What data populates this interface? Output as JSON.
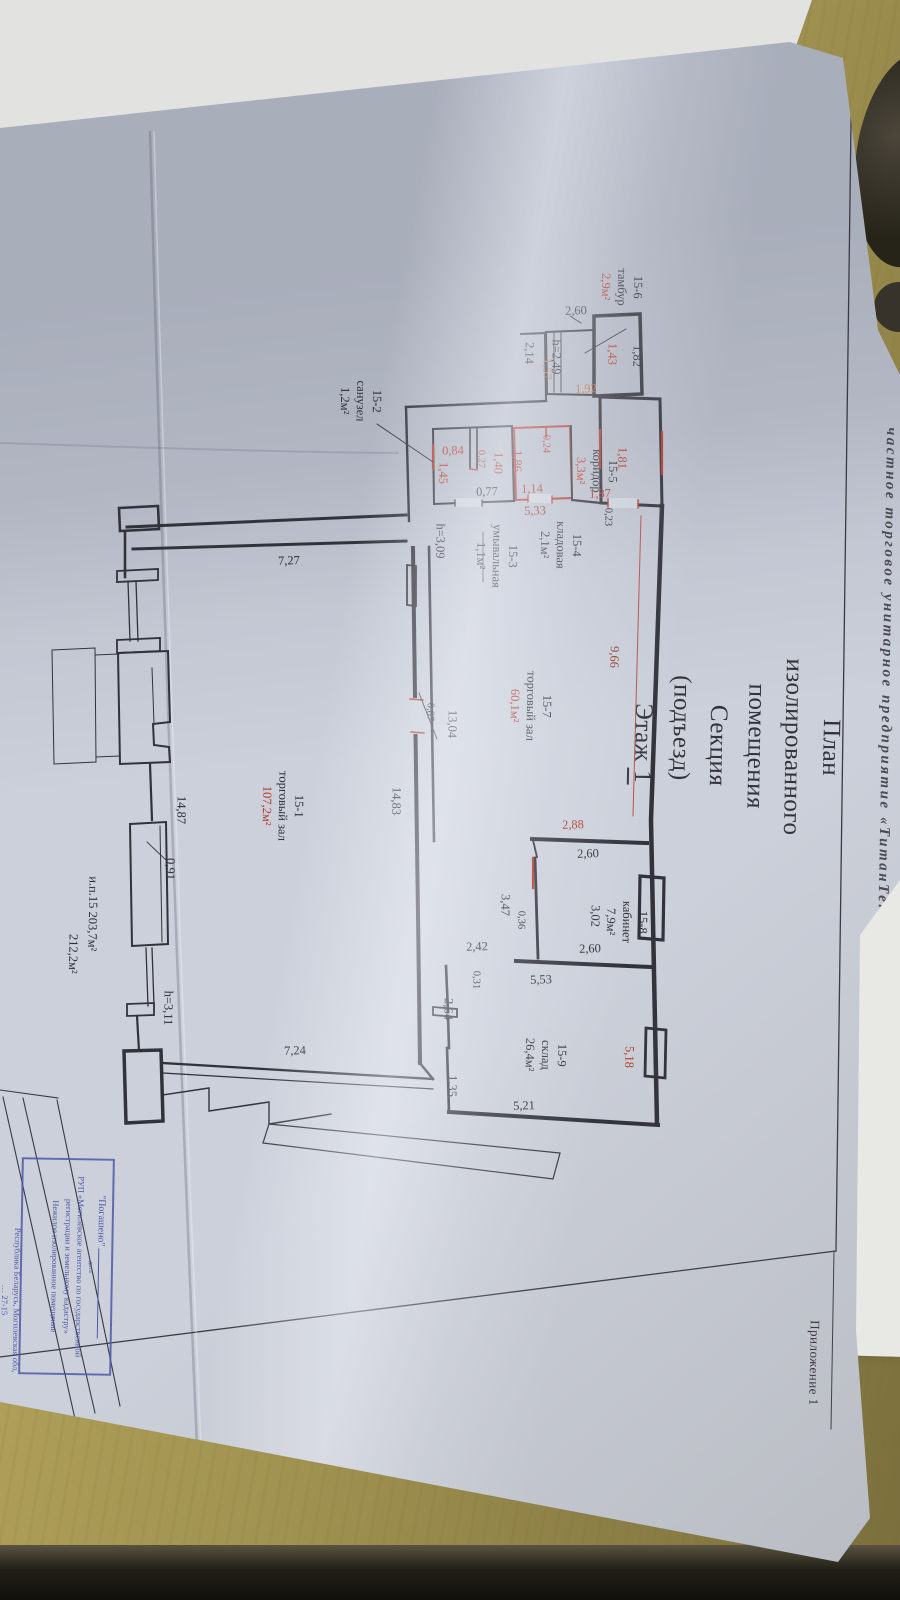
{
  "document": {
    "appendix": "Приложение 1",
    "org_header": "частное торговое унитарное предприятие «ТитанТекс-Т»",
    "title_line1": "План изолированного помещения",
    "title_line2a": "Секция (подъезд)",
    "title_line2b": "Этаж",
    "title_line2c": "1",
    "summary_line1": "и.п.15  203,7м²",
    "summary_line2": "212,2м²"
  },
  "rooms": [
    {
      "id": "15-1",
      "name": "торговый зал",
      "area": "107,2м²"
    },
    {
      "id": "15-2",
      "name": "санузел",
      "area": "1,2м²"
    },
    {
      "id": "15-3",
      "name": "умывальная",
      "area": "1,1м²"
    },
    {
      "id": "15-4",
      "name": "кладовая",
      "area": "2,1м²"
    },
    {
      "id": "15-5",
      "name": "коридор",
      "area": "3,3м²"
    },
    {
      "id": "15-6",
      "name": "тамбур",
      "area": "2,9м²"
    },
    {
      "id": "15-7",
      "name": "торговый зал",
      "area": "60,1м²"
    },
    {
      "id": "15-8",
      "name": "кабинет",
      "area": "7,9м²"
    },
    {
      "id": "15-9",
      "name": "склад",
      "area": "26,4м²"
    }
  ],
  "dims": [
    {
      "v": "2,60"
    },
    {
      "v": "2,14"
    },
    {
      "v": "h=2,49"
    },
    {
      "v": "1,57"
    },
    {
      "v": "1,43"
    },
    {
      "v": "1,82"
    },
    {
      "v": "1,92"
    },
    {
      "v": "1,81"
    },
    {
      "v": "1,87"
    },
    {
      "v": "0,23"
    },
    {
      "v": "0,24"
    },
    {
      "v": "9,66"
    },
    {
      "v": "0,84"
    },
    {
      "v": "0,27"
    },
    {
      "v": "1,40"
    },
    {
      "v": "1,86"
    },
    {
      "v": "1,45"
    },
    {
      "v": "0,77"
    },
    {
      "v": "1,14"
    },
    {
      "v": "5,33"
    },
    {
      "v": "h=3,09"
    },
    {
      "v": "7,27"
    },
    {
      "v": "13,04"
    },
    {
      "v": "0,87"
    },
    {
      "v": "14,83"
    },
    {
      "v": "2,88"
    },
    {
      "v": "2,60"
    },
    {
      "v": "3,02"
    },
    {
      "v": "3,47"
    },
    {
      "v": "0,36"
    },
    {
      "v": "2,42"
    },
    {
      "v": "0,31"
    },
    {
      "v": "2,64"
    },
    {
      "v": "5,53"
    },
    {
      "v": "2,60"
    },
    {
      "v": "5,18"
    },
    {
      "v": "1,35"
    },
    {
      "v": "5,21"
    },
    {
      "v": "0,91"
    },
    {
      "v": "h=3,11"
    },
    {
      "v": "7,24"
    },
    {
      "v": "14,87"
    }
  ],
  "stamp": {
    "line1": "\"Погашено\"",
    "date_label": "дата",
    "line2": "РУП «Могилевское агентство по государственной",
    "line3": "регистрации и земельному кадастру»",
    "line4": "Нежилое изолированное помещение",
    "line5": "Республика Беларусь, Могилевская обл,",
    "line6": "… 27-15"
  },
  "ink_colors": {
    "black": "#2e2e36",
    "red": "#b03a2c",
    "orange": "#c4693a",
    "dark_red": "#8f3a28",
    "stamp_blue": "#4d58a6",
    "paper": "#ccd0da",
    "desk_wood": "#a99b58"
  }
}
